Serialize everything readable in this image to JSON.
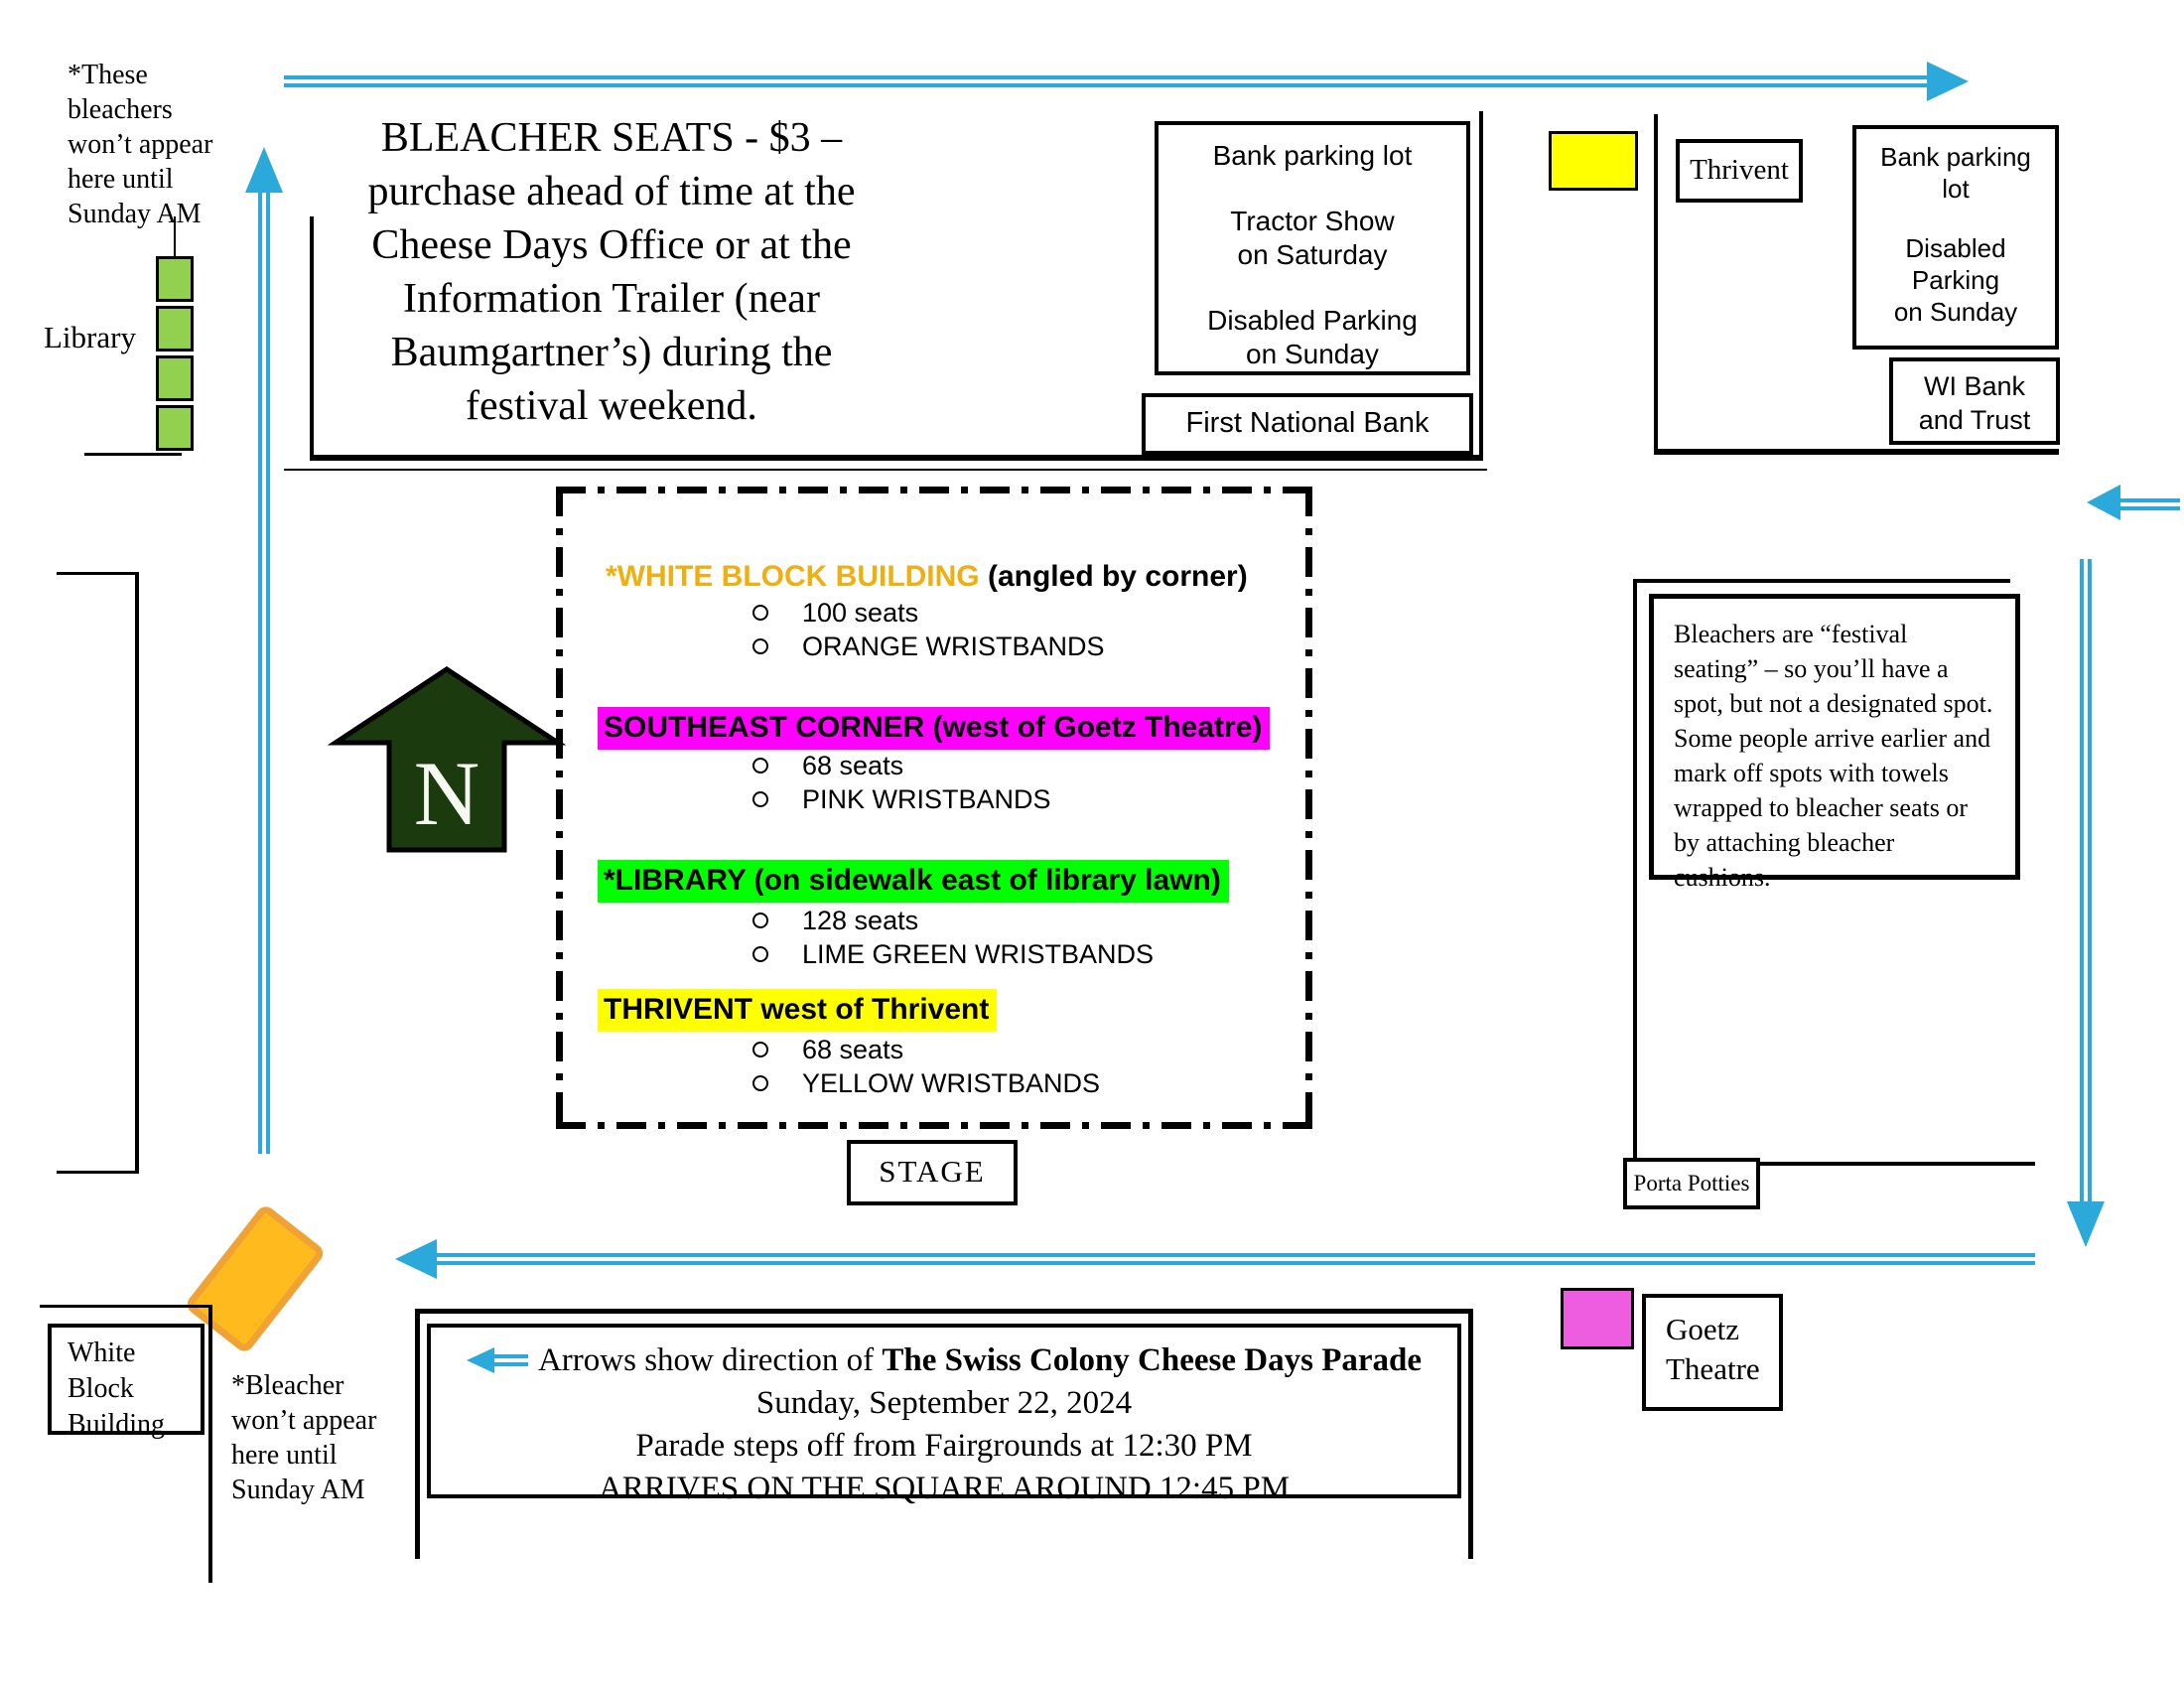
{
  "colors": {
    "arrow_blue": "#2BA9DB",
    "north_arrow_green": "#1B3A0E",
    "bleacher_green": "#92D050",
    "highlight_magenta": "#FF00FF",
    "highlight_green": "#00FF00",
    "highlight_yellow": "#FFFF00",
    "orange_text": "#EFAF10",
    "goetz_pink": "#EE5CE0",
    "orange_block": "#FFBA1E",
    "orange_block_border": "#F0A235",
    "yellow_block": "#FFFF00"
  },
  "top_left": {
    "bleacher_note": [
      "*These",
      "bleachers",
      "won’t appear",
      "here until",
      "Sunday AM"
    ],
    "library_label": "Library"
  },
  "north_block": {
    "notice_lines": [
      "BLEACHER SEATS - $3 –",
      "purchase ahead of time at the",
      "Cheese Days Office or at the",
      "Information Trailer (near",
      "Baumgartner’s) during the",
      "festival weekend."
    ],
    "bank_parking_lot": [
      "Bank parking lot",
      "Tractor Show",
      "on Saturday",
      "Disabled Parking",
      "on Sunday"
    ],
    "first_national_bank": "First National Bank"
  },
  "northeast_block": {
    "thrivent": "Thrivent",
    "bank_parking_lot": [
      "Bank parking",
      "lot",
      "Disabled",
      "Parking",
      "on Sunday"
    ],
    "wi_bank": [
      "WI Bank",
      "and Trust"
    ]
  },
  "seating_legend": {
    "sections": [
      {
        "title": "*WHITE BLOCK BUILDING",
        "subtitle": " (angled by corner)",
        "seats": "100 seats",
        "wristbands": "ORANGE WRISTBANDS"
      },
      {
        "title": "SOUTHEAST CORNER (west of Goetz Theatre)",
        "subtitle": "",
        "seats": "68 seats",
        "wristbands": "PINK WRISTBANDS"
      },
      {
        "title": "*LIBRARY (on sidewalk east of library lawn)",
        "subtitle": "",
        "seats": "128 seats",
        "wristbands": "LIME GREEN WRISTBANDS"
      },
      {
        "title": "THRIVENT west of Thrivent",
        "subtitle": "",
        "seats": "68 seats",
        "wristbands": "YELLOW WRISTBANDS"
      }
    ]
  },
  "compass_label": "N",
  "stage_label": "STAGE",
  "southeast_block": {
    "festival_note": "Bleachers are “festival seating” – so you’ll have a spot, but not a designated spot.  Some people arrive earlier and mark off spots with towels wrapped to bleacher seats or by attaching bleacher cushions.",
    "porta_potties": "Porta Potties",
    "goetz_theatre": [
      "Goetz",
      "Theatre"
    ]
  },
  "southwest": {
    "white_block_building": [
      "White",
      "Block",
      "Building"
    ],
    "bleacher_note": [
      "*Bleacher",
      "won’t appear",
      "here until",
      "Sunday AM"
    ]
  },
  "parade_box": {
    "line1_prefix": "Arrows show direction of ",
    "line1_bold": "The Swiss Colony Cheese Days Parade",
    "line2": "Sunday, September 22, 2024",
    "line3": "Parade steps off from Fairgrounds at 12:30 PM",
    "line4": "ARRIVES ON THE SQUARE AROUND 12:45 PM"
  }
}
